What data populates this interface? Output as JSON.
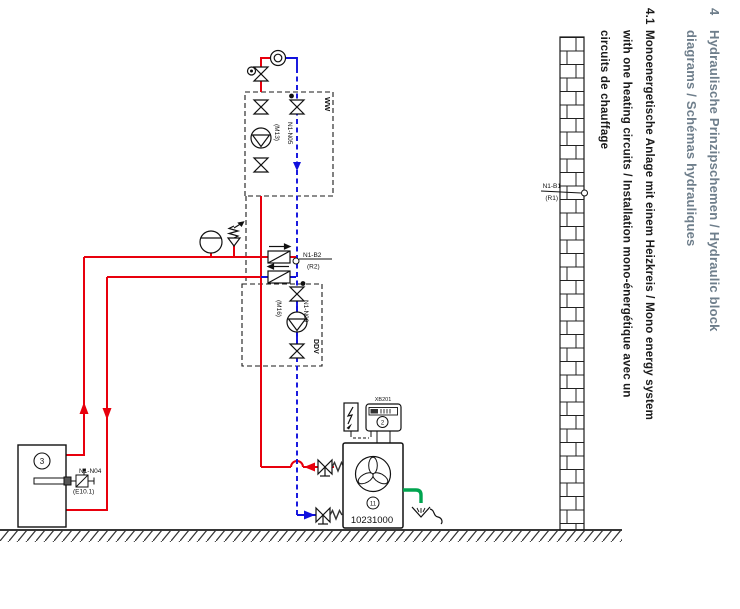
{
  "header": {
    "number": "4",
    "line1": "Hydraulische Prinzipschemen / Hydraulic block",
    "line2": "diagrams / Schémas hydrauliques",
    "color": "#6e7e8b"
  },
  "section": {
    "number": "4.1",
    "line1": "Monoenergetische Anlage mit einem Heizkreis / Mono energy system",
    "line2": "with one heating circuits / Installation mono-énergétique avec un",
    "line3": "circuits de chauffage"
  },
  "diagram": {
    "dhw_box_label": "WW",
    "heating_box_label": "DDV",
    "dhw_pump": {
      "code": "N1-N05",
      "alt": "(M13)"
    },
    "heating_pump": {
      "code": "N1-N09",
      "alt": "(M16)"
    },
    "flow_sensor": {
      "code": "N1-B2",
      "alt": "(R2)"
    },
    "outdoor_sensor": {
      "code": "N1-B1",
      "alt": "(R1)"
    },
    "immersion_heater": {
      "code": "N1-N04",
      "alt": "(E10.1)"
    },
    "heat_pump": {
      "ref": "11",
      "model_number": "10231000",
      "terminal_label": "XB201"
    },
    "controller_ref": "2",
    "tank_ref": "3"
  },
  "colors": {
    "supply_pipe": "#e8000d",
    "return_pipe": "#1010dd",
    "drain_pipe": "#00a44f",
    "line": "#1a1a1a",
    "header_text": "#6e7e8b"
  }
}
